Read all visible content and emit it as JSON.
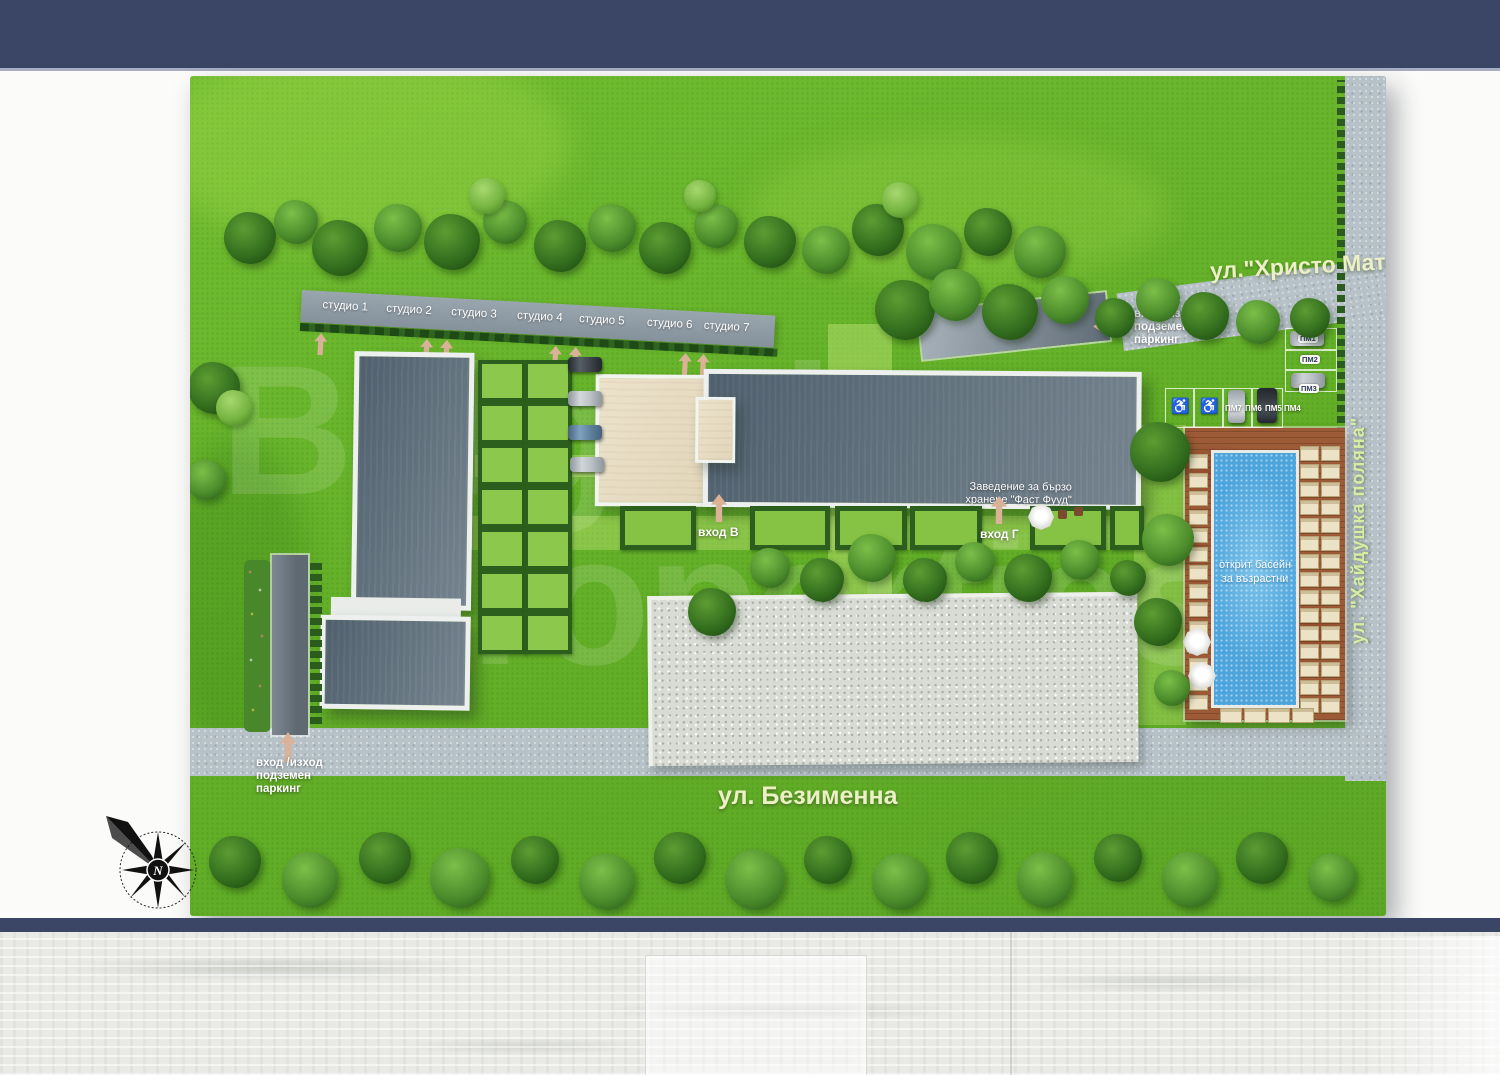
{
  "site": {
    "streets": {
      "top": "ул.\"Христо Матов\"",
      "right": "ул. \"Хайдушка поляна\"",
      "bottom": "ул. Безименна"
    },
    "studios": [
      "студио 1",
      "студио 2",
      "студио 3",
      "студио 4",
      "студио 5",
      "студио 6",
      "студио 7"
    ],
    "entrances": {
      "a": "вход А",
      "b": "вход Б",
      "v": "вход В",
      "g": "вход Г"
    },
    "garage": {
      "line1": "вход /изход",
      "line2": "подземен",
      "line3": "паркинг"
    },
    "fastfood": {
      "line1": "Заведение за бързо",
      "line2": "хранене \"Фаст Фууд\""
    },
    "pool": {
      "line1": "открит басейн",
      "line2": "за възрастни"
    },
    "parking": {
      "spots": [
        "ПМ1",
        "ПМ2",
        "ПМ3",
        "ПМ4",
        "ПМ5",
        "ПМ6",
        "ПМ7"
      ]
    },
    "compass": {
      "north": "N"
    },
    "watermark": {
      "line1": "Bulgarian",
      "line2": "Properties"
    }
  },
  "colors": {
    "navy": "#3b4565",
    "grass": "#68b42c",
    "roof_dark": "#5f6e7d",
    "roof_beige": "#e8dfc8",
    "pool_water": "#4da4dc",
    "deck_wood": "#9b5a38",
    "road": "#b7c2c9",
    "street_label": "#edf0c6",
    "arrow": "#d9b298"
  }
}
